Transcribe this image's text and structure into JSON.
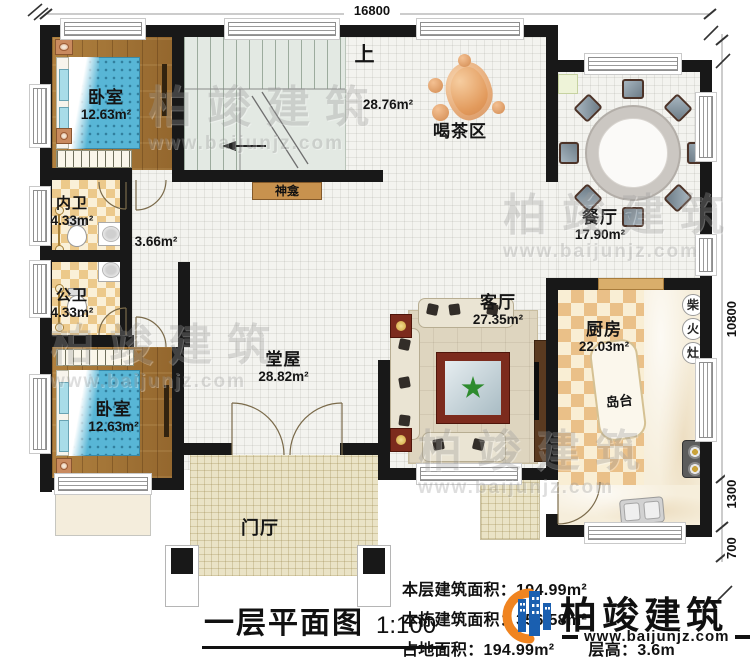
{
  "plan": {
    "title": "一层平面图",
    "scale": "1:100",
    "dims": {
      "top": "16800",
      "right": "10800",
      "right_mid": "1300",
      "right_low": "700"
    },
    "rooms": {
      "bedroom_top": {
        "name": "卧室",
        "area": "12.63m²"
      },
      "bedroom_bottom": {
        "name": "卧室",
        "area": "12.63m²"
      },
      "inner_bath": {
        "name": "内卫",
        "area": "4.33m²"
      },
      "public_bath": {
        "name": "公卫",
        "area": "4.33m²"
      },
      "hall": {
        "name": "堂屋",
        "area": "28.82m²"
      },
      "tea": {
        "name": "喝茶区",
        "area": "28.76m²"
      },
      "dining": {
        "name": "餐厅",
        "area": "17.90m²"
      },
      "living": {
        "name": "客厅",
        "area": "27.35m²"
      },
      "kitchen": {
        "name": "厨房",
        "area": "22.03m²"
      },
      "foyer": {
        "name": "门厅"
      },
      "shrine": {
        "name": "神龛"
      },
      "island": {
        "name": "岛台"
      },
      "corridor_area": "3.66m²",
      "stairs_up": "上",
      "wood_stove": {
        "c1": "柴",
        "c2": "火",
        "c3": "灶"
      }
    }
  },
  "stats": {
    "l1_label": "本层建筑面积：",
    "l1_value": "194.99m²",
    "l2_label": "本栋建筑面积：",
    "l2_value": "356.58m²",
    "l3_label": "占地面积：",
    "l3_value": "194.99m²",
    "l4_label": "层高：",
    "l4_value": "3.6m"
  },
  "brand": {
    "name": "柏竣建筑",
    "url": "www.baijunjz.com"
  },
  "watermark": {
    "name": "柏竣建筑",
    "url": "www.baijunjz.com"
  }
}
